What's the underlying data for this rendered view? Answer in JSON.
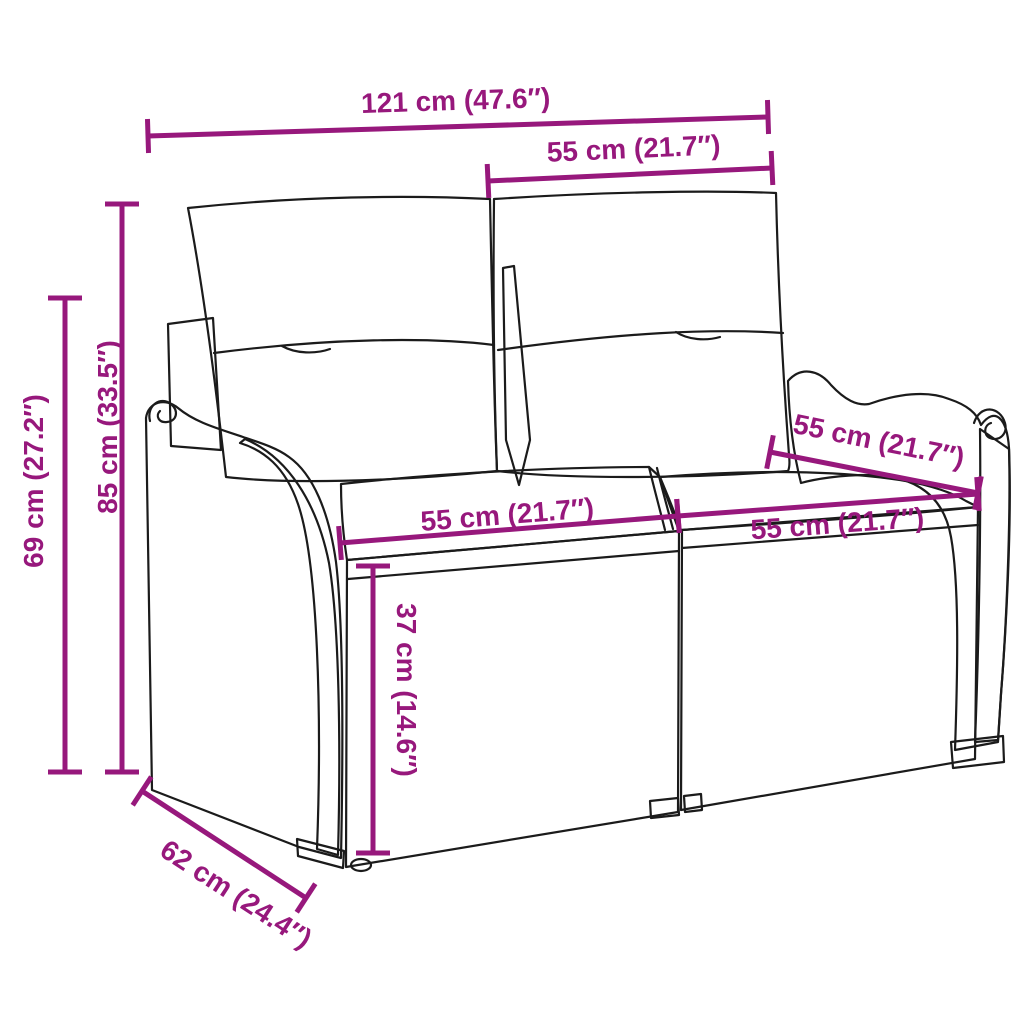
{
  "page": {
    "background": "#ffffff"
  },
  "diagram": {
    "type": "product-dimension-diagram",
    "subject": "poly rattan 2-seater garden bench with back and seat cushions",
    "accent_color": "#97187C",
    "line_color": "#1b1b1b"
  },
  "dimensions": [
    {
      "id": "overall-width",
      "label": "121 cm (47.6″)",
      "line": {
        "x1": 148,
        "y1": 136,
        "x2": 768,
        "y2": 117
      },
      "label_pos": {
        "x": 456,
        "y": 110,
        "angle": -1.8
      }
    },
    {
      "id": "seat-section-top",
      "label": "55 cm (21.7″)",
      "line": {
        "x1": 488,
        "y1": 181,
        "x2": 772,
        "y2": 168
      },
      "label_pos": {
        "x": 634,
        "y": 158,
        "angle": -2.5
      }
    },
    {
      "id": "overall-height",
      "label": "85 cm (33.5″)",
      "line": {
        "x1": 122,
        "y1": 204,
        "x2": 122,
        "y2": 772
      },
      "label_pos": {
        "x": 117,
        "y": 427,
        "angle": -90
      }
    },
    {
      "id": "armrest-height",
      "label": "69 cm (27.2″)",
      "line": {
        "x1": 65,
        "y1": 298,
        "x2": 65,
        "y2": 772
      },
      "label_pos": {
        "x": 43,
        "y": 481,
        "angle": -90
      }
    },
    {
      "id": "seat-depth-top",
      "label": "55 cm (21.7″)",
      "line": {
        "x1": 770,
        "y1": 452,
        "x2": 978,
        "y2": 493
      },
      "label_pos": {
        "x": 877,
        "y": 450,
        "angle": 11.5
      }
    },
    {
      "id": "seat-width-left",
      "label": "55 cm (21.7″)",
      "line": {
        "x1": 340,
        "y1": 543,
        "x2": 678,
        "y2": 516
      },
      "label_pos": {
        "x": 508,
        "y": 524,
        "angle": -4.6
      }
    },
    {
      "id": "seat-width-right",
      "label": "55 cm (21.7″)",
      "line": {
        "x1": 678,
        "y1": 516,
        "x2": 978,
        "y2": 494
      },
      "label_pos": {
        "x": 838,
        "y": 533,
        "angle": -4.2
      }
    },
    {
      "id": "seat-height",
      "label": "37 cm (14.6″)",
      "line": {
        "x1": 373,
        "y1": 566,
        "x2": 373,
        "y2": 853
      },
      "label_pos": {
        "x": 397,
        "y": 690,
        "angle": 90
      }
    },
    {
      "id": "seat-depth-bottom",
      "label": "62 cm (24.4″)",
      "line": {
        "x1": 142,
        "y1": 791,
        "x2": 306,
        "y2": 898
      },
      "label_pos": {
        "x": 231,
        "y": 902,
        "angle": 33
      }
    }
  ]
}
